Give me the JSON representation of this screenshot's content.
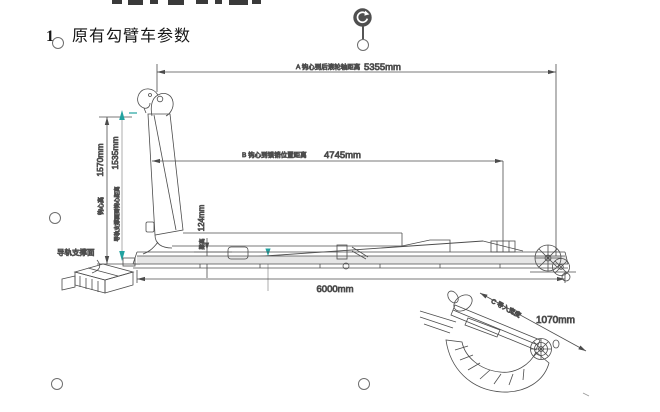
{
  "doc": {
    "heading_num": "1、",
    "heading_text": "原有勾臂车参数"
  },
  "drawing": {
    "dim_a_label": "A 钩心到后滚轮轴距离",
    "dim_a_value": "5355mm",
    "dim_b_label": "B 钩心到锁销位置距离",
    "dim_b_value": "4745mm",
    "dim_hook_height_label": "钩心高",
    "dim_hook_height_value": "1570mm",
    "dim_rail_hook_label": "导轨支撑面到钩心距离",
    "dim_rail_hook_value": "1535mm",
    "dim_beam_label": "梁高",
    "dim_beam_value": "124mm",
    "dim_length_value": "6000mm",
    "dim_inlet_label": "C 导入宽度",
    "dim_inlet_value": "1070mm",
    "rail_surface_label": "导轨支撑面",
    "colors": {
      "teal_accent": "#21a2a0",
      "line": "#4c4c4c",
      "handle_gray": "#6e6e6e",
      "rotate_dark": "#4f4f4f"
    }
  }
}
